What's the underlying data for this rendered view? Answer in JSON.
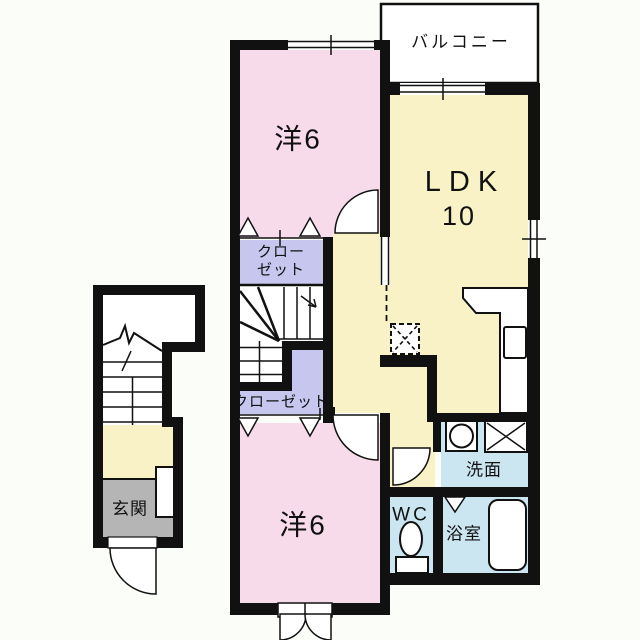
{
  "floorplan": {
    "type": "apartment-floor-plan",
    "labels": {
      "balcony": "バルコニー",
      "room_upper": "洋6",
      "ldk": "LDK",
      "ldk_size": "10",
      "closet_upper_l1": "クロー",
      "closet_upper_l2": "ゼット",
      "closet_lower": "クローゼット",
      "room_lower": "洋6",
      "washroom": "洗面",
      "toilet": "WC",
      "bathroom": "浴室",
      "entrance": "玄関"
    },
    "colors": {
      "wall": "#111111",
      "western_room_pink": "#F7DBEA",
      "ldk_yellow": "#F8F2C6",
      "closet_lavender": "#C6C6EF",
      "wet_area_blue": "#CBE5F1",
      "entrance_gray": "#B5B5B5",
      "background": "#FAFDF8",
      "fixture_white": "#FFFFFF"
    }
  }
}
